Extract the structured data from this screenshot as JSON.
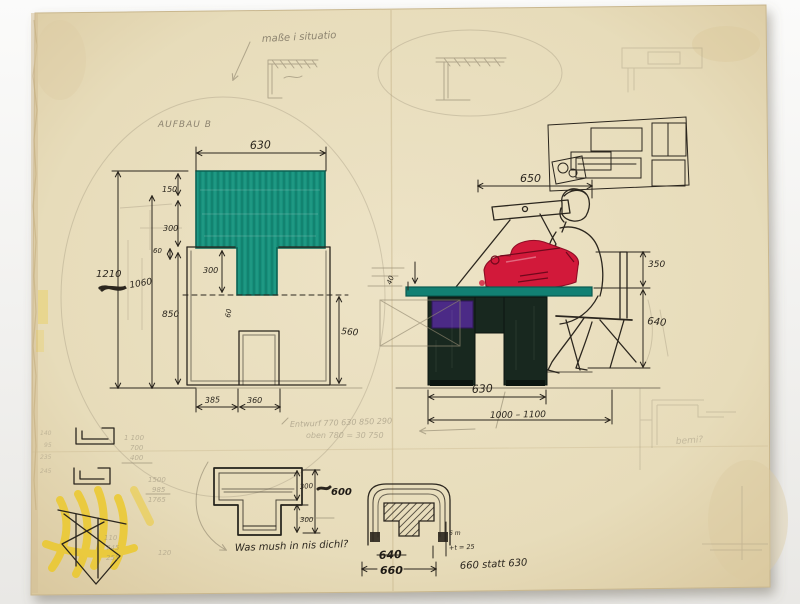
{
  "scene": {
    "description": "Hand-drawn furniture design sketch (drawing desk, front and side views) on aged paper",
    "aufbau_label": "AUFBAU B"
  },
  "colors": {
    "paper": "#e9dfc2",
    "teal": "#17907c",
    "red": "#d2193a",
    "purple": "#4b2a86",
    "desk_dark": "#18281f",
    "ink": "#2b261e",
    "pencil": "#938a72",
    "yellow": "#ecc92c"
  },
  "notes": {
    "top_note": "maße i situatio",
    "pencil_note_line1": "Entwurf 770 630 850 290",
    "pencil_note_line2": "oben 780 = 30 750",
    "question_note": "Was mush in nis dichl?",
    "statt_note": "660 statt 630",
    "detail_small_1": "6 m",
    "detail_small_2": "+t = 25",
    "corner_scribble": "bemi?"
  },
  "front_view": {
    "width_top": "630",
    "height_overall": "1210",
    "height_inner": "1060",
    "top_bar": "150",
    "upper": "300",
    "small": "60",
    "lower": "850",
    "column": "300",
    "tiny": "60",
    "opening_height": "560",
    "leg_width": "385",
    "opening_width": "360"
  },
  "side_view": {
    "depth_top": "650",
    "above_top": "350",
    "top_height": "640",
    "base_depth": "630",
    "range": "1000 – 1100",
    "tiny": "40"
  },
  "section": {
    "upper": "300",
    "lower": "300",
    "total": "600",
    "bold_crossed": "640",
    "bold_width": "660"
  },
  "calc": {
    "col1": [
      "1 100",
      "700",
      "400"
    ],
    "col2": [
      "1500",
      "985",
      "1765"
    ],
    "col3": [
      "110",
      "745",
      "255"
    ],
    "col4": [
      "140",
      "95",
      "235",
      "245"
    ],
    "extra": "120"
  }
}
